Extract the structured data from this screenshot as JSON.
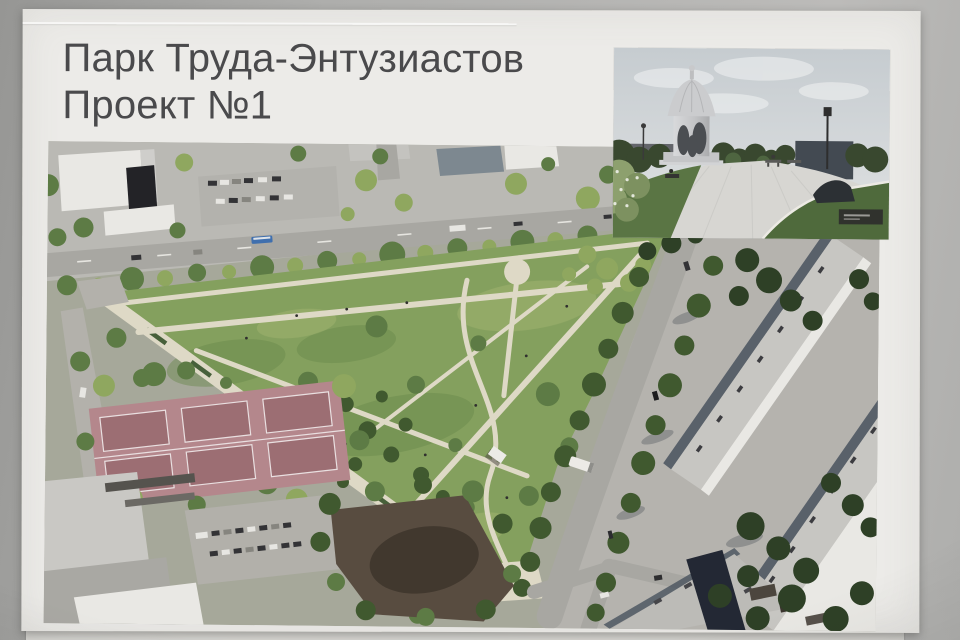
{
  "poster": {
    "title": {
      "line1": "Парк Труда-Энтузиастов",
      "line2": "Проект №1"
    }
  },
  "palette": {
    "wall": "#aeaeac",
    "wall_dark": "#969694",
    "wall_light": "#bcbbb9",
    "sheet_under": "#d6d5d1",
    "poster_bg": "#ecebe8",
    "title_color": "#4a4a4c",
    "park_green": "#84a05e",
    "park_green_dark": "#69884b",
    "tree_light": "#8fa75f",
    "tree_green": "#5d7b45",
    "tree_dark": "#40592f",
    "urban_gray": "#bab9b4",
    "road_gray": "#a8a7a2",
    "path_cream": "#ded9c6",
    "court_pink": "#b4878c",
    "court_pink_dark": "#9c6e73",
    "asphalt": "#b3b1ab",
    "building_white": "#e9e8e4",
    "building_dark": "#232327",
    "roof_gray": "#c7c6c2",
    "shadow_blue": "#49525e",
    "dirt_brown": "#584c40",
    "dirt_dark": "#3d352b",
    "bus_blue": "#3f6fae",
    "inset_sky": "#ccd1d4",
    "inset_pavement": "#d7d6d2",
    "inset_green": "#5a7544",
    "inset_dark_tree": "#39482f",
    "monument_gray": "#cbccce"
  }
}
